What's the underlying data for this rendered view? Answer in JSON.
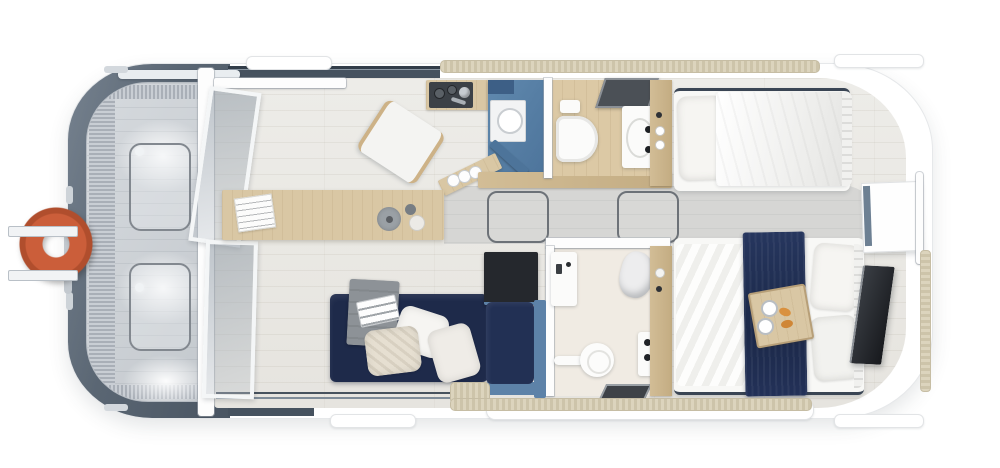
{
  "scene": {
    "name": "houseboat-floor-plan-top-view",
    "view": "top-down 3d render",
    "canvas": {
      "width": 1000,
      "height": 468
    }
  },
  "colors": {
    "bg": "#ffffff",
    "hull-dark-1": "#76828f",
    "hull-dark-2": "#495562",
    "deck-floor": "#ccd1d6",
    "deck-ridge-a": "#c9ced4",
    "deck-ridge-b": "#a9afb7",
    "hatch-line": "#82888f",
    "life-ring": "#cb5e3a",
    "glass-tint": "#9aa4ae",
    "frame-white": "#f4f6f7",
    "cabin-floor": "#edecE8",
    "corridor-floor": "#d6d6d4",
    "wood": "#d9c7a4",
    "wood-deep": "#c9b48c",
    "navy": "#1e2a4a",
    "steel-blue": "#5d82a8",
    "steel-blue-deep": "#3d5f86",
    "appliance-dark": "#3c4147",
    "cabinet-dark": "#25282d",
    "tv-dark": "#2b2f34",
    "throw-gray": "#8d9297",
    "linen": "#f6f5f2",
    "knit": "#e6dfd1",
    "pad-beige-a": "#dcd4bd",
    "pad-beige-b": "#cdc4aa",
    "window-band": "#3f4a56"
  },
  "rooms": {
    "bow_deck": {
      "name": "bow-deck",
      "items": [
        "life-ring",
        "deck-hatch",
        "deck-hatch",
        "ridged-trim",
        "ceiling-light-glow"
      ]
    },
    "partition": {
      "name": "glass-partition",
      "items": [
        "door-track",
        "open-glass-door",
        "glass-panel"
      ]
    },
    "saloon": {
      "name": "saloon",
      "items": [
        "dining-table",
        "newspaper",
        "serving-plate",
        "cup",
        "bowl",
        "folding-chair",
        "corner-sofa",
        "throw-blanket",
        "tablet",
        "pillows",
        "storage-cabinet"
      ]
    },
    "galley": {
      "name": "galley",
      "items": [
        "cooktop-counter",
        "tall-blue-cabinet",
        "sink",
        "open-cabinet-door",
        "mug-shelf",
        "mugs"
      ]
    },
    "bathroom_fore": {
      "name": "bathroom-fore",
      "items": [
        "shower-tray",
        "toilet",
        "vanity-sink"
      ]
    },
    "bathroom_aft": {
      "name": "bathroom-aft",
      "items": [
        "vanity-sink",
        "towel",
        "toilet",
        "shower-panel",
        "floor-drain"
      ]
    },
    "corridor": {
      "name": "corridor",
      "items": [
        "floor-hatch",
        "floor-hatch"
      ]
    },
    "cabin_fore": {
      "name": "bedroom-fore",
      "items": [
        "side-shelf",
        "single-bed",
        "pillow",
        "duvet"
      ]
    },
    "cabin_aft": {
      "name": "bedroom-aft",
      "items": [
        "wardrobe",
        "double-bed",
        "navy-runner",
        "breakfast-tray",
        "coffee-cups",
        "croissants",
        "pillows"
      ]
    },
    "stern": {
      "name": "stern",
      "items": [
        "window-panel",
        "tv-screen",
        "fender-strip"
      ]
    },
    "exterior": {
      "name": "exterior",
      "items": [
        "mooring-pad",
        "side-walkway-pad",
        "swim-platform"
      ]
    }
  }
}
